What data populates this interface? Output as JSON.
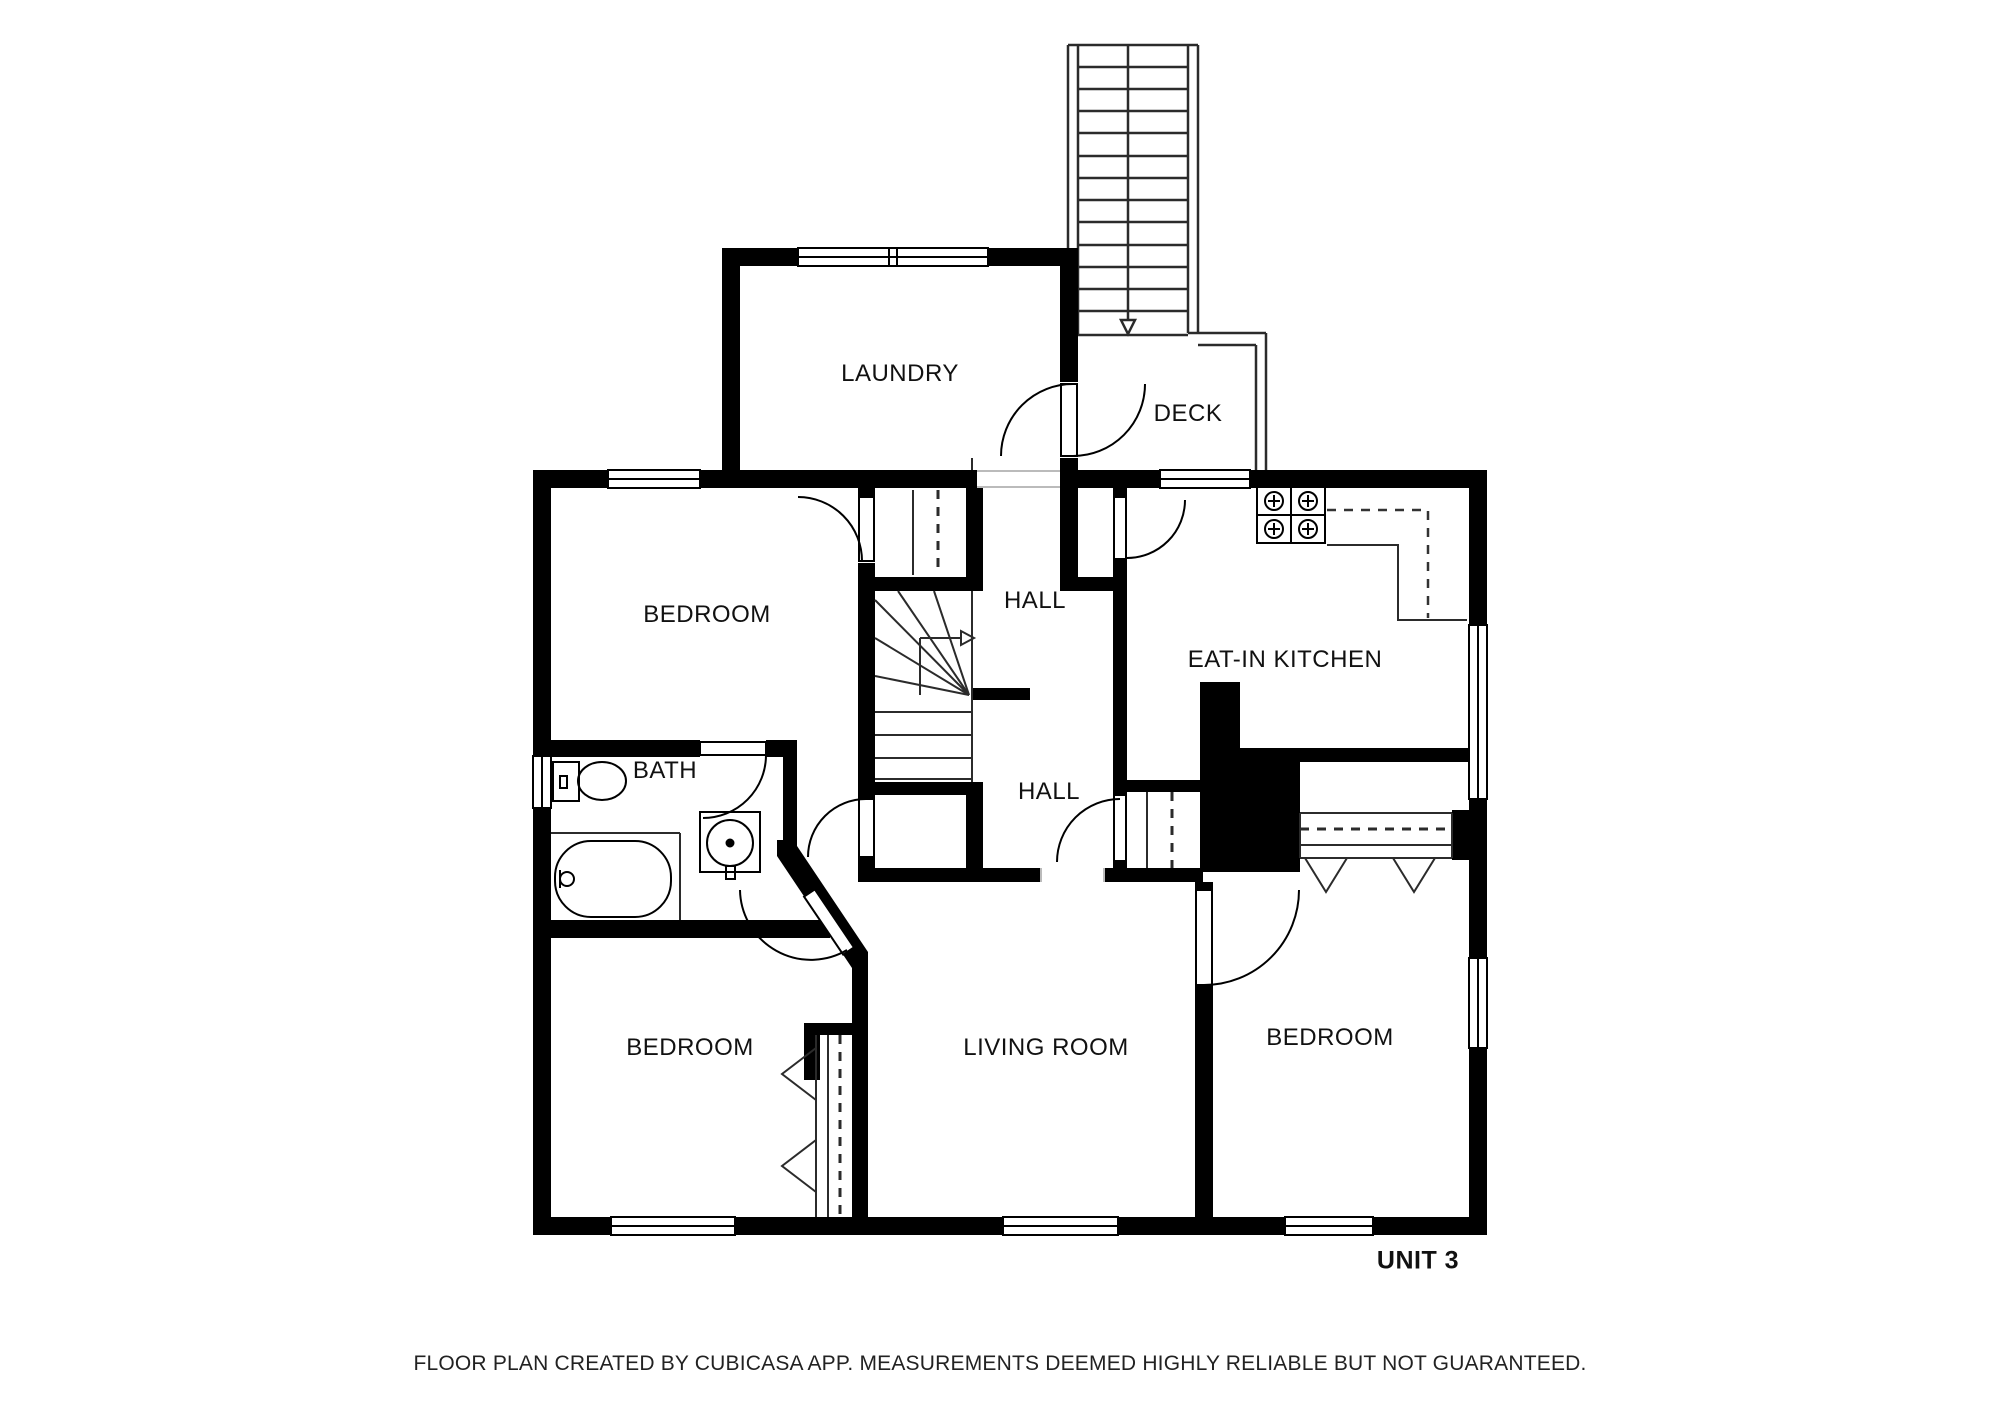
{
  "logo": {
    "copyright": "©2025",
    "brand_bay": "BAY",
    "brand_east": "EAST",
    "tagline": "ASSOCIATION OF REALTORS®"
  },
  "rooms": {
    "laundry": "LAUNDRY",
    "deck": "DECK",
    "bedroom_top_left": "BEDROOM",
    "hall_upper": "HALL",
    "kitchen": "EAT-IN KITCHEN",
    "bath": "BATH",
    "hall_lower": "HALL",
    "bedroom_bottom_left": "BEDROOM",
    "living_room": "LIVING ROOM",
    "bedroom_right": "BEDROOM"
  },
  "unit_label": "UNIT 3",
  "disclaimer": "FLOOR PLAN CREATED BY CUBICASA APP. MEASUREMENTS DEEMED HIGHLY RELIABLE BUT NOT GUARANTEED.",
  "colors": {
    "wall": "#000000",
    "background": "#ffffff",
    "stair_line": "#2b2b2b",
    "dashed_line": "#333333",
    "logo_blue": "#24519f",
    "logo_gray": "#9aa2ab",
    "label_text": "#111111"
  },
  "symbols": [
    "toilet",
    "bathtub",
    "sink",
    "stove",
    "staircase-exterior",
    "staircase-interior",
    "winder-stairs",
    "closet-rod",
    "bifold-door",
    "door-swing",
    "window"
  ]
}
